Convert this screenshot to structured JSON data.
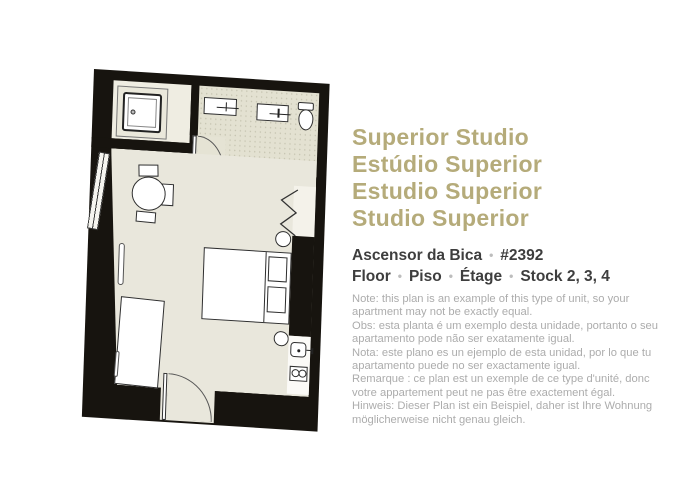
{
  "colors": {
    "accent_title": "#b5ab7a",
    "heading_text": "#3e3e3e",
    "note_text": "#acacac",
    "wall": "#17140f",
    "room_floor": "#e9e7dc",
    "bathroom_floor": "#e3e1d1"
  },
  "titles": [
    "Superior Studio",
    "Estúdio Superior",
    "Estudio Superior",
    "Studio Superior"
  ],
  "separator": "•",
  "property": {
    "name": "Ascensor da Bica",
    "unit": "#2392"
  },
  "floor_row": [
    "Floor",
    "Piso",
    "Étage",
    "Stock 2, 3, 4"
  ],
  "notes": [
    "Note: this plan is an example of this type of unit, so your apartment may not be exactly equal.",
    "Obs: esta planta é um exemplo desta unidade, portanto o seu apartamento pode não ser exatamente igual.",
    "Nota: este plano es un ejemplo de esta unidad, por lo que tu apartamento puede no ser exactamente igual.",
    "Remarque : ce plan est un exemple de ce type d'unité, donc votre appartement peut ne pas être exactement égal.",
    "Hinweis: Dieser Plan ist ein Beispiel, daher ist Ihre Wohnung möglicherweise nicht genau gleich."
  ],
  "floorplan": {
    "rooms": [
      "shower-alcove",
      "bathroom",
      "main-studio-room",
      "entry"
    ],
    "furniture": [
      "shower",
      "vanity-sink-left",
      "vanity-sink-right",
      "toilet",
      "dining-table",
      "chairs",
      "window",
      "radiator",
      "wardrobe",
      "double-bed",
      "pillows",
      "stool-top",
      "stool-bottom",
      "clothes-rail",
      "kitchen-sink",
      "two-burner-hob",
      "bathroom-door",
      "entry-door"
    ]
  }
}
